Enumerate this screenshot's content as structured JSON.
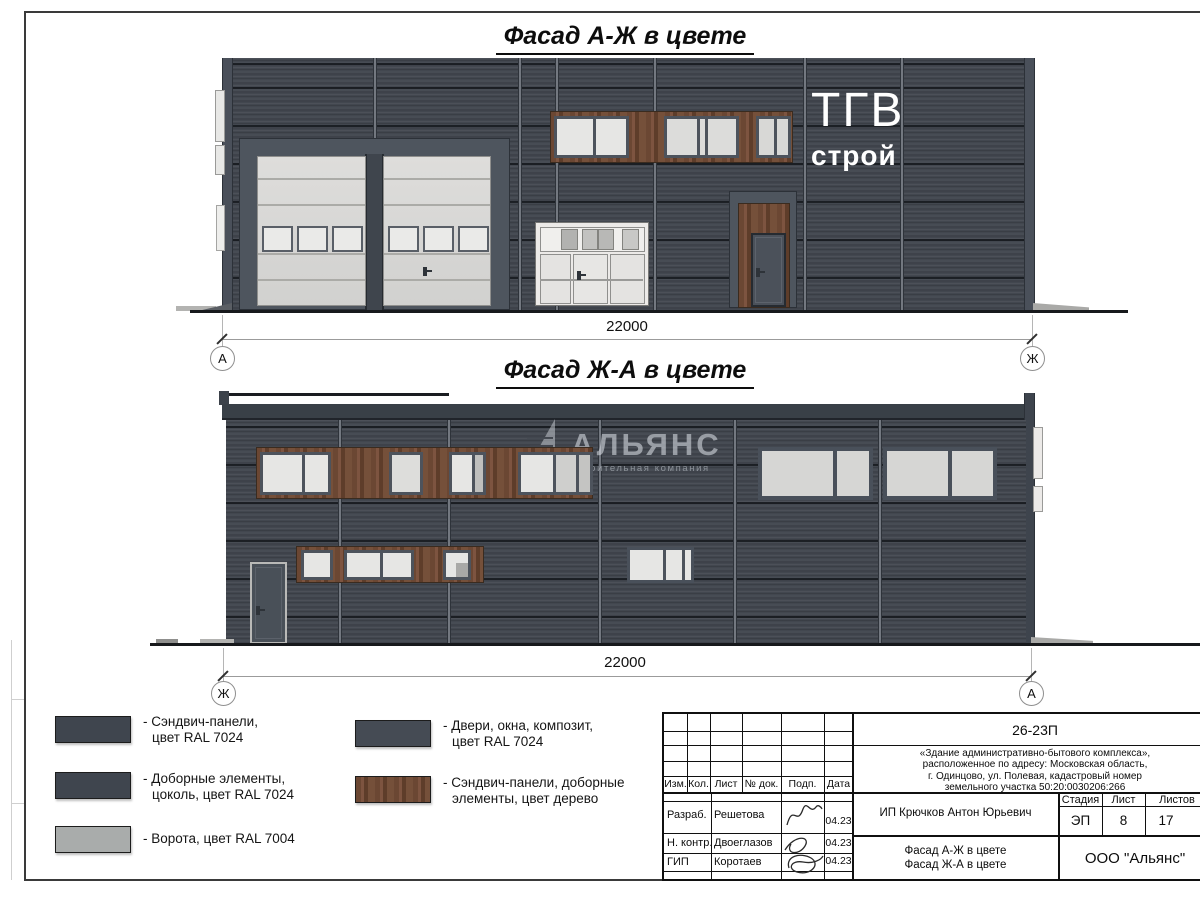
{
  "sheet": {
    "title_top": "Фасад А-Ж в цвете",
    "title_bottom": "Фасад Ж-А в цвете"
  },
  "facade_top": {
    "dimension": "22000",
    "axis_left": "А",
    "axis_right": "Ж",
    "logo_line1": "ТГВ",
    "logo_line2": "строй"
  },
  "facade_bottom": {
    "dimension": "22000",
    "axis_left": "Ж",
    "axis_right": "А",
    "watermark_title": "АЛЬЯНС",
    "watermark_subtitle": "строительная компания"
  },
  "legend": {
    "items": [
      {
        "line1": "- Сэндвич-панели,",
        "line2": "цвет RAL 7024"
      },
      {
        "line1": "- Доборные элементы,",
        "line2": "цоколь, цвет RAL 7024"
      },
      {
        "line1": "- Ворота, цвет RAL 7004",
        "line2": ""
      },
      {
        "line1": "- Двери, окна, композит,",
        "line2": "цвет RAL 7024"
      },
      {
        "line1": "- Сэндвич-панели, доборные",
        "line2": "элементы, цвет дерево"
      }
    ]
  },
  "title_block": {
    "doc_code": "26-23П",
    "address_lines": [
      "«Здание административно-бытового комплекса»,",
      "расположенное по адресу: Московская область,",
      "г. Одинцово, ул. Полевая, кадастровый номер",
      "земельного участка 50:20:0030206:266"
    ],
    "columns": [
      "Изм.",
      "Кол.",
      "Лист",
      "№ док.",
      "Подп.",
      "Дата"
    ],
    "rows": [
      {
        "role": "Разраб.",
        "name": "Решетова",
        "date": "04.23"
      },
      {
        "role": "Н. контр.",
        "name": "Двоеглазов",
        "date": "04.23"
      },
      {
        "role": "ГИП",
        "name": "Коротаев",
        "date": "04.23"
      }
    ],
    "client": "ИП Крючков Антон Юрьевич",
    "stage_label": "Стадия",
    "sheet_label": "Лист",
    "sheets_label": "Листов",
    "stage_value": "ЭП",
    "sheet_value": "8",
    "sheets_value": "17",
    "subject_lines": [
      "Фасад А-Ж в цвете",
      "Фасад Ж-А в цвете"
    ],
    "company": "ООО \"Альянс\""
  },
  "colors": {
    "facade_panel": "#42474f",
    "wood_panel": "#6e4a36",
    "gate_ral7004": "#d9d9d7",
    "elements_ral7024": "#4d535c",
    "legend_dark": "#3f454e",
    "legend_gate": "#a9acab"
  }
}
